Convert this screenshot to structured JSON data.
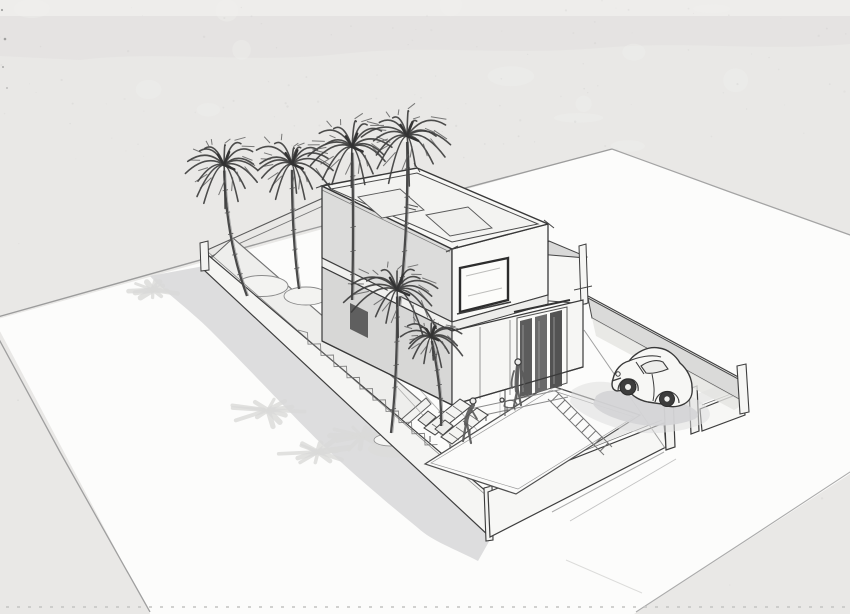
{
  "canvas": {
    "width": 850,
    "height": 614,
    "label": "architectural-concept-sketch"
  },
  "palette": {
    "paper": "#e9e8e6",
    "paper_top": "#e3e2e0",
    "paper_band": "#eeedeb",
    "plane": "#fcfcfb",
    "pencil_edge": "#9c9c9c",
    "shadow": "#d7d7d8",
    "splat": "#d9d9d8",
    "wall_face": "#f6f6f4",
    "wall_ink": "#3e3e3e",
    "house_shade": "#dcdcdb",
    "house_light": "#f9f9f7",
    "roof": "#f7f7f5",
    "roof_inner": "#f3f3f1",
    "ink": "#3a3a3a",
    "frond": "#3e3e3e",
    "trunk": "#4a4a4a",
    "door_dark": "#5c5c5c",
    "glass": "#fcfcfa"
  },
  "scene": {
    "palms": [
      {
        "id": "palm-back-1",
        "cx": 224,
        "cy": 165,
        "r": 40,
        "bx": 247,
        "by": 296,
        "lean": -10,
        "seed": 11
      },
      {
        "id": "palm-back-2",
        "cx": 292,
        "cy": 164,
        "r": 42,
        "bx": 299,
        "by": 289,
        "lean": -4,
        "seed": 22
      },
      {
        "id": "palm-back-3",
        "cx": 352,
        "cy": 147,
        "r": 41,
        "bx": 352,
        "by": 300,
        "lean": 2,
        "seed": 33
      },
      {
        "id": "palm-back-4",
        "cx": 407,
        "cy": 136,
        "r": 43,
        "bx": 399,
        "by": 306,
        "lean": 6,
        "seed": 44
      },
      {
        "id": "palm-courtyard-big",
        "cx": 397,
        "cy": 290,
        "r": 47,
        "bx": 391,
        "by": 433,
        "lean": 4,
        "seed": 55
      },
      {
        "id": "palm-courtyard-small",
        "cx": 431,
        "cy": 337,
        "r": 30,
        "bx": 441,
        "by": 426,
        "lean": 6,
        "seed": 66
      }
    ],
    "shadow_splats": [
      {
        "cx": 153,
        "cy": 290,
        "r": 30,
        "seed": 3
      },
      {
        "cx": 268,
        "cy": 410,
        "r": 42,
        "seed": 5
      },
      {
        "cx": 318,
        "cy": 452,
        "r": 40,
        "seed": 7
      },
      {
        "cx": 362,
        "cy": 436,
        "r": 34,
        "seed": 9
      }
    ],
    "car": {
      "shadow_d": "M596,396 C606,388 618,390 630,396 C648,392 668,396 684,404 C696,409 702,414 695,419 C678,426 652,428 632,423 C614,419 597,412 593,404 Z",
      "shadow_halo_d": "M572,390 C590,378 612,380 632,390 C656,384 680,390 698,400 C712,408 714,418 702,424 C680,433 648,436 624,430 C600,424 576,412 570,402 Z",
      "body_d": "M613,379 C615,370 621,363 629,361 C636,352 648,346 659,348 C668,349 676,356 680,363 C687,369 692,378 692,387 C693,395 690,401 684,404 C676,408 668,407 662,404 L648,402 C643,401 638,399 634,396 C630,392 622,390 617,391 C612,390 611,385 613,379 Z",
      "detail_paths": [
        {
          "d": "M629,361 C638,357 652,354 661,357",
          "w": 1.1
        },
        {
          "d": "M636,362 L644,374",
          "w": 1.1
        },
        {
          "d": "M652,374 C654,384 655,392 653,401",
          "w": 1.0
        },
        {
          "d": "M655,402 C657,394 664,390 671,392 C676,394 679,398 679,403",
          "w": 1.2
        },
        {
          "d": "M618,391 C618,383 623,378 630,379 C636,380 639,385 638,391",
          "w": 1.2
        },
        {
          "d": "M612,381 L621,378",
          "w": 1.3
        }
      ],
      "glass_d": "M641,366 C648,361 657,359 663,362 L668,369 C661,372 652,374 646,373 Z",
      "wheels": [
        {
          "cx": 628,
          "cy": 387,
          "r": 8,
          "hub": 3
        },
        {
          "cx": 667,
          "cy": 399,
          "r": 7.5,
          "hub": 2.7
        }
      ],
      "headlight": {
        "cx": 618,
        "cy": 374,
        "r": 2.2
      }
    },
    "figures": [
      {
        "id": "figure-standing",
        "head": [
          518,
          362,
          3.1
        ],
        "strokes": [
          {
            "d": "M518,366 C517,374 516,383 517,391",
            "w": 4.2
          },
          {
            "d": "M514,371 C512,377 511,383 512,388",
            "w": 1.8
          },
          {
            "d": "M522,371 C524,377 525,382 524,387",
            "w": 1.8
          },
          {
            "d": "M517,391 L514,406",
            "w": 2.2
          },
          {
            "d": "M518,391 L521,405",
            "w": 2.2
          }
        ]
      },
      {
        "id": "figure-crouching",
        "head": [
          473,
          401,
          3.0
        ],
        "strokes": [
          {
            "d": "M473,405 C469,411 466,417 466,424",
            "w": 4.2
          },
          {
            "d": "M466,424 L463,441",
            "w": 2.2
          },
          {
            "d": "M467,424 L471,443",
            "w": 2.2
          },
          {
            "d": "M471,409 L477,419",
            "w": 1.8
          }
        ]
      },
      {
        "id": "figure-dog",
        "head": [
          502,
          400,
          2.0
        ],
        "strokes": [
          {
            "d": "M505,402 C509,399 515,400 517,404 C516,408 508,409 504,406 Z",
            "w": 1.2
          },
          {
            "d": "M507,407 L507,411 M514,406 L515,410",
            "w": 1.1
          }
        ]
      }
    ],
    "texture": {
      "speckle_seed": 42,
      "speckle_count": 140,
      "blob_count": 14
    }
  }
}
